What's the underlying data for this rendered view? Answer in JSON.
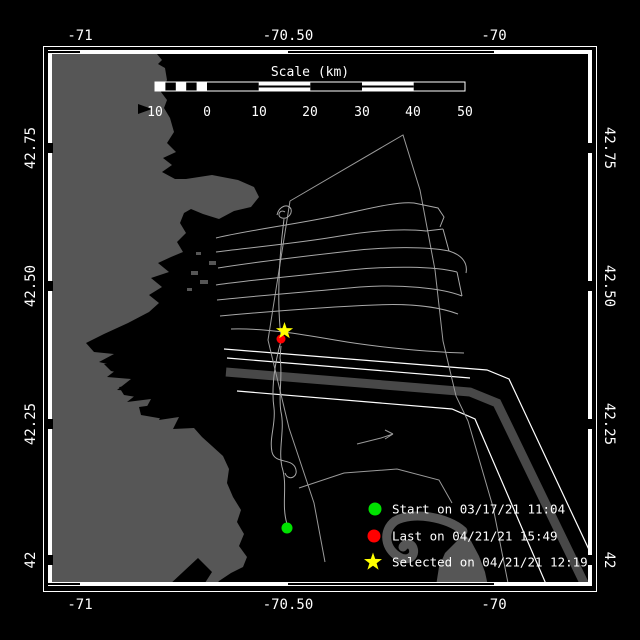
{
  "window": {
    "background": "#000000",
    "frame_color": "#ffffff"
  },
  "axes": {
    "lon_ticks": [
      {
        "label": "-71"
      },
      {
        "label": "-70.50"
      },
      {
        "label": "-70"
      }
    ],
    "lat_ticks": [
      {
        "label": "42.75"
      },
      {
        "label": "42.50"
      },
      {
        "label": "42.25"
      },
      {
        "label": "42"
      }
    ]
  },
  "scalebar": {
    "title": "Scale (km)",
    "tick_labels": [
      {
        "label": "10"
      },
      {
        "label": "0"
      },
      {
        "label": "10"
      },
      {
        "label": "20"
      },
      {
        "label": "30"
      },
      {
        "label": "40"
      },
      {
        "label": "50"
      }
    ]
  },
  "legend": {
    "items": [
      {
        "marker": "green-circle",
        "marker_color": "#00e200",
        "label": "Start on 03/17/21 11:04"
      },
      {
        "marker": "red-circle",
        "marker_color": "#ff0000",
        "label": "Last on 04/21/21 15:49"
      },
      {
        "marker": "yellow-star",
        "marker_color": "#ffff00",
        "label": "Selected on 04/21/21 12:19"
      }
    ]
  },
  "map_colors": {
    "land": "#565656",
    "water": "#000000",
    "track": "#a8a8a8",
    "survey_line": "#9a9a9a",
    "tss_zone": "#484848",
    "tss_line": "#ffffff"
  },
  "chart_data": {
    "type": "map",
    "x_axis": {
      "label": "longitude",
      "ticks": [
        -71,
        -70.5,
        -70
      ]
    },
    "y_axis": {
      "label": "latitude",
      "ticks": [
        42.75,
        42.5,
        42.25,
        42
      ]
    },
    "scale_km_ticks": [
      10,
      0,
      10,
      20,
      30,
      40,
      50
    ],
    "points": [
      {
        "name": "start",
        "marker": "green-circle",
        "date": "03/17/21 11:04"
      },
      {
        "name": "last",
        "marker": "red-circle",
        "date": "04/21/21 15:49"
      },
      {
        "name": "selected",
        "marker": "yellow-star",
        "date": "04/21/21 12:19"
      }
    ]
  }
}
